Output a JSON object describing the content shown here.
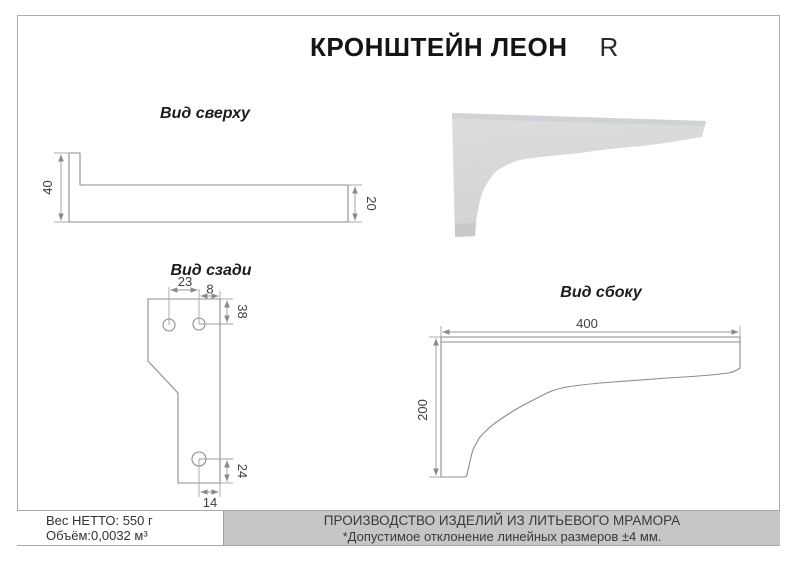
{
  "sheet": {
    "title": "КРОНШТЕЙН ЛЕОН",
    "title_suffix": "R"
  },
  "views": {
    "top": {
      "label": "Вид сверху",
      "dim_height": "40",
      "dim_thickness": "20"
    },
    "back": {
      "label": "Вид сзади",
      "dim_hole_spacing": "23",
      "dim_hole_to_edge": "8",
      "dim_top_to_hole": "38",
      "dim_hole_to_bottom": "24",
      "dim_hole_to_side": "14"
    },
    "side": {
      "label": "Вид сбоку",
      "dim_length": "400",
      "dim_height": "200"
    }
  },
  "photo": {
    "description": "bracket-3d-render"
  },
  "footer": {
    "net_weight": "Вес НЕТТО: 550 г",
    "volume": "Объём:0,0032 м³",
    "production": "ПРОИЗВОДСТВО ИЗДЕЛИЙ ИЗ ЛИТЬЕВОГО МРАМОРА",
    "tolerance": "*Допустимое отклонение линейных размеров ±4 мм."
  },
  "colors": {
    "border": "#ababab",
    "outline": "#8c8c8c",
    "dim_line": "#9a9a9a",
    "dim_text": "#3f3f3f",
    "footer_bg": "#c6c6c6",
    "photo_fill": "#d5d7d8"
  }
}
